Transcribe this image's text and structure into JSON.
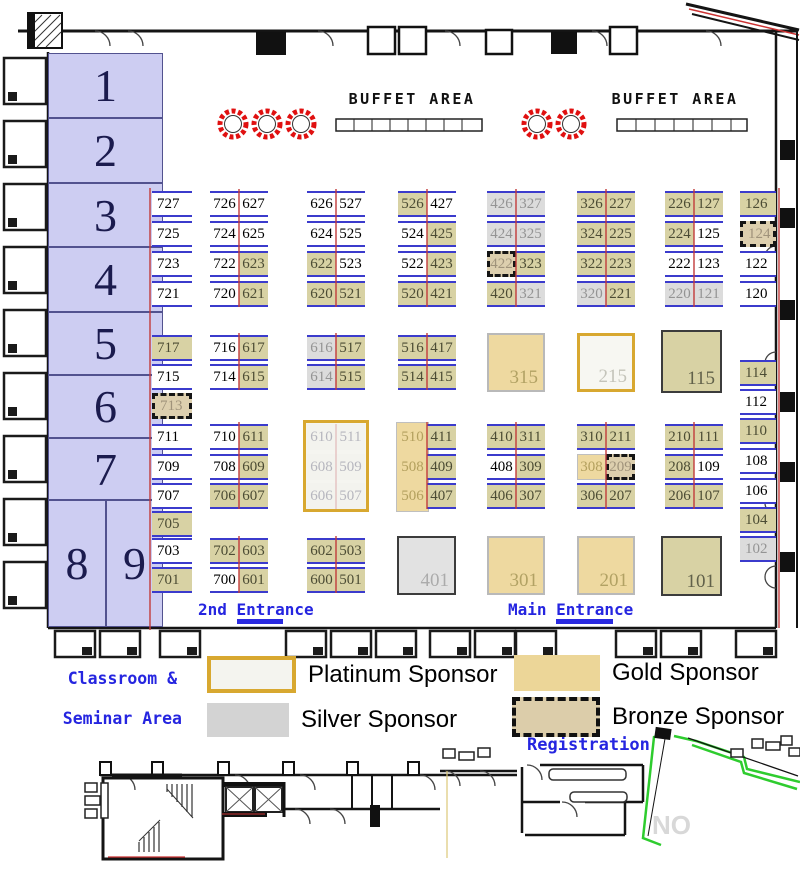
{
  "labels": {
    "buffet_area_1": "BUFFET AREA",
    "buffet_area_2": "BUFFET AREA",
    "second_entrance": "2nd Entrance",
    "main_entrance": "Main Entrance",
    "classroom_line1": "Classroom &",
    "classroom_line2": "Seminar Area",
    "registration": "Registration",
    "watermark": "NO"
  },
  "legend": {
    "items": [
      {
        "type": "platinum",
        "label": "Platinum Sponsor"
      },
      {
        "type": "silver",
        "label": "Silver Sponsor"
      },
      {
        "type": "gold",
        "label": "Gold Sponsor"
      },
      {
        "type": "bronze",
        "label": "Bronze Sponsor"
      }
    ]
  },
  "colors": {
    "gold_booth": "#d8d2a4",
    "gold_bright": "#eed9a0",
    "silver_booth": "#dcdcdc",
    "bronze_booth": "#ddcfae",
    "platinum_border": "#d8a830",
    "booth_line_blue": "#3b3bcc",
    "divider_red": "#cc2222",
    "label_blue": "#2525e0",
    "classroom_fill": "#cdcdf2"
  },
  "classrooms": {
    "fields": [
      "number",
      "x",
      "y",
      "w",
      "h"
    ],
    "rows": [
      [
        "1",
        48,
        53,
        115,
        65
      ],
      [
        "2",
        48,
        118,
        115,
        65
      ],
      [
        "3",
        48,
        183,
        115,
        64
      ],
      [
        "4",
        48,
        247,
        115,
        65
      ],
      [
        "5",
        48,
        312,
        115,
        63
      ],
      [
        "6",
        48,
        375,
        115,
        63
      ],
      [
        "7",
        48,
        438,
        115,
        62
      ],
      [
        "8",
        48,
        500,
        58,
        127
      ],
      [
        "9",
        106,
        500,
        57,
        127
      ]
    ]
  },
  "booths": {
    "fields": [
      "number",
      "x",
      "y",
      "w",
      "h",
      "type"
    ],
    "rows": [
      [
        "727",
        152,
        191,
        40,
        26,
        "std"
      ],
      [
        "725",
        152,
        221,
        40,
        26,
        "std"
      ],
      [
        "723",
        152,
        251,
        40,
        26,
        "std"
      ],
      [
        "721",
        152,
        281,
        40,
        26,
        "std"
      ],
      [
        "726",
        210,
        191,
        29,
        26,
        "std"
      ],
      [
        "627",
        239,
        191,
        29,
        26,
        "std"
      ],
      [
        "724",
        210,
        221,
        29,
        26,
        "std"
      ],
      [
        "625",
        239,
        221,
        29,
        26,
        "std"
      ],
      [
        "722",
        210,
        251,
        29,
        26,
        "std"
      ],
      [
        "623",
        239,
        251,
        29,
        26,
        "gold"
      ],
      [
        "720",
        210,
        281,
        29,
        26,
        "std"
      ],
      [
        "621",
        239,
        281,
        29,
        26,
        "gold"
      ],
      [
        "626",
        307,
        191,
        29,
        26,
        "std"
      ],
      [
        "527",
        336,
        191,
        29,
        26,
        "std"
      ],
      [
        "624",
        307,
        221,
        29,
        26,
        "std"
      ],
      [
        "525",
        336,
        221,
        29,
        26,
        "std"
      ],
      [
        "622",
        307,
        251,
        29,
        26,
        "gold"
      ],
      [
        "523",
        336,
        251,
        29,
        26,
        "std"
      ],
      [
        "620",
        307,
        281,
        29,
        26,
        "gold"
      ],
      [
        "521",
        336,
        281,
        29,
        26,
        "gold"
      ],
      [
        "526",
        398,
        191,
        29,
        26,
        "gold"
      ],
      [
        "427",
        427,
        191,
        29,
        26,
        "std"
      ],
      [
        "524",
        398,
        221,
        29,
        26,
        "std"
      ],
      [
        "425",
        427,
        221,
        29,
        26,
        "gold"
      ],
      [
        "522",
        398,
        251,
        29,
        26,
        "std"
      ],
      [
        "423",
        427,
        251,
        29,
        26,
        "gold"
      ],
      [
        "520",
        398,
        281,
        29,
        26,
        "gold"
      ],
      [
        "421",
        427,
        281,
        29,
        26,
        "gold"
      ],
      [
        "426",
        487,
        191,
        29,
        26,
        "silver"
      ],
      [
        "327",
        516,
        191,
        29,
        26,
        "silver"
      ],
      [
        "424",
        487,
        221,
        29,
        26,
        "silver"
      ],
      [
        "325",
        516,
        221,
        29,
        26,
        "silver"
      ],
      [
        "422",
        487,
        251,
        29,
        26,
        "bronze"
      ],
      [
        "323",
        516,
        251,
        29,
        26,
        "gold"
      ],
      [
        "420",
        487,
        281,
        29,
        26,
        "gold"
      ],
      [
        "321",
        516,
        281,
        29,
        26,
        "silver"
      ],
      [
        "326",
        577,
        191,
        29,
        26,
        "gold"
      ],
      [
        "227",
        606,
        191,
        29,
        26,
        "gold"
      ],
      [
        "324",
        577,
        221,
        29,
        26,
        "gold"
      ],
      [
        "225",
        606,
        221,
        29,
        26,
        "gold"
      ],
      [
        "322",
        577,
        251,
        29,
        26,
        "gold"
      ],
      [
        "223",
        606,
        251,
        29,
        26,
        "gold"
      ],
      [
        "320",
        577,
        281,
        29,
        26,
        "silver"
      ],
      [
        "221",
        606,
        281,
        29,
        26,
        "gold"
      ],
      [
        "226",
        665,
        191,
        29,
        26,
        "gold"
      ],
      [
        "127",
        694,
        191,
        29,
        26,
        "gold"
      ],
      [
        "224",
        665,
        221,
        29,
        26,
        "gold"
      ],
      [
        "125",
        694,
        221,
        29,
        26,
        "std"
      ],
      [
        "222",
        665,
        251,
        29,
        26,
        "std"
      ],
      [
        "123",
        694,
        251,
        29,
        26,
        "std"
      ],
      [
        "220",
        665,
        281,
        29,
        26,
        "silver"
      ],
      [
        "121",
        694,
        281,
        29,
        26,
        "silver"
      ],
      [
        "126",
        740,
        191,
        36,
        26,
        "gold"
      ],
      [
        "124",
        740,
        221,
        36,
        26,
        "bronze"
      ],
      [
        "122",
        740,
        251,
        36,
        26,
        "std"
      ],
      [
        "120",
        740,
        281,
        36,
        26,
        "std"
      ],
      [
        "717",
        152,
        335,
        40,
        26,
        "gold"
      ],
      [
        "715",
        152,
        364,
        40,
        26,
        "std"
      ],
      [
        "713",
        152,
        393,
        40,
        26,
        "bronze"
      ],
      [
        "716",
        210,
        335,
        29,
        26,
        "std"
      ],
      [
        "617",
        239,
        335,
        29,
        26,
        "gold"
      ],
      [
        "714",
        210,
        364,
        29,
        26,
        "std"
      ],
      [
        "615",
        239,
        364,
        29,
        26,
        "gold"
      ],
      [
        "616",
        307,
        335,
        29,
        26,
        "silver"
      ],
      [
        "517",
        336,
        335,
        29,
        26,
        "gold"
      ],
      [
        "614",
        307,
        364,
        29,
        26,
        "silver"
      ],
      [
        "515",
        336,
        364,
        29,
        26,
        "gold"
      ],
      [
        "516",
        398,
        335,
        29,
        26,
        "gold"
      ],
      [
        "417",
        427,
        335,
        29,
        26,
        "gold"
      ],
      [
        "514",
        398,
        364,
        29,
        26,
        "gold"
      ],
      [
        "415",
        427,
        364,
        29,
        26,
        "gold"
      ],
      [
        "315",
        487,
        333,
        58,
        59,
        "goldb"
      ],
      [
        "215",
        577,
        333,
        58,
        59,
        "plat"
      ],
      [
        "115",
        661,
        330,
        61,
        63,
        "bigg"
      ],
      [
        "114",
        740,
        360,
        36,
        26,
        "gold"
      ],
      [
        "112",
        740,
        389,
        36,
        26,
        "std"
      ],
      [
        "711",
        152,
        424,
        40,
        26,
        "std"
      ],
      [
        "709",
        152,
        454,
        40,
        26,
        "std"
      ],
      [
        "707",
        152,
        483,
        40,
        26,
        "std"
      ],
      [
        "705",
        152,
        511,
        40,
        26,
        "gold"
      ],
      [
        "710",
        210,
        424,
        29,
        26,
        "std"
      ],
      [
        "611",
        239,
        424,
        29,
        26,
        "gold"
      ],
      [
        "708",
        210,
        454,
        29,
        26,
        "std"
      ],
      [
        "609",
        239,
        454,
        29,
        26,
        "gold"
      ],
      [
        "706",
        210,
        483,
        29,
        26,
        "gold"
      ],
      [
        "607",
        239,
        483,
        29,
        26,
        "gold"
      ],
      [
        "610",
        307,
        424,
        29,
        26,
        "platc"
      ],
      [
        "511",
        336,
        424,
        29,
        26,
        "platc"
      ],
      [
        "608",
        307,
        454,
        29,
        26,
        "platc"
      ],
      [
        "509",
        336,
        454,
        29,
        26,
        "platc"
      ],
      [
        "606",
        307,
        483,
        29,
        26,
        "platc"
      ],
      [
        "507",
        336,
        483,
        29,
        26,
        "platc"
      ],
      [
        "510",
        398,
        424,
        29,
        26,
        "goldf"
      ],
      [
        "411",
        427,
        424,
        29,
        26,
        "gold"
      ],
      [
        "508",
        398,
        454,
        29,
        26,
        "goldf"
      ],
      [
        "409",
        427,
        454,
        29,
        26,
        "gold"
      ],
      [
        "506",
        398,
        483,
        29,
        26,
        "goldf"
      ],
      [
        "407",
        427,
        483,
        29,
        26,
        "gold"
      ],
      [
        "410",
        487,
        424,
        29,
        26,
        "gold"
      ],
      [
        "311",
        516,
        424,
        29,
        26,
        "gold"
      ],
      [
        "408",
        487,
        454,
        29,
        26,
        "std"
      ],
      [
        "309",
        516,
        454,
        29,
        26,
        "gold"
      ],
      [
        "406",
        487,
        483,
        29,
        26,
        "gold"
      ],
      [
        "307",
        516,
        483,
        29,
        26,
        "gold"
      ],
      [
        "310",
        577,
        424,
        29,
        26,
        "gold"
      ],
      [
        "211",
        606,
        424,
        29,
        26,
        "gold"
      ],
      [
        "308",
        577,
        454,
        29,
        26,
        "goldc"
      ],
      [
        "209",
        606,
        454,
        29,
        26,
        "bronze"
      ],
      [
        "306",
        577,
        483,
        29,
        26,
        "gold"
      ],
      [
        "207",
        606,
        483,
        29,
        26,
        "gold"
      ],
      [
        "210",
        665,
        424,
        29,
        26,
        "gold"
      ],
      [
        "111",
        694,
        424,
        29,
        26,
        "gold"
      ],
      [
        "208",
        665,
        454,
        29,
        26,
        "gold"
      ],
      [
        "109",
        694,
        454,
        29,
        26,
        "std"
      ],
      [
        "206",
        665,
        483,
        29,
        26,
        "gold"
      ],
      [
        "107",
        694,
        483,
        29,
        26,
        "gold"
      ],
      [
        "110",
        740,
        418,
        36,
        26,
        "gold"
      ],
      [
        "108",
        740,
        448,
        36,
        26,
        "std"
      ],
      [
        "106",
        740,
        478,
        36,
        26,
        "std"
      ],
      [
        "104",
        740,
        507,
        36,
        26,
        "gold"
      ],
      [
        "102",
        740,
        536,
        36,
        26,
        "silver"
      ],
      [
        "703",
        152,
        538,
        40,
        26,
        "std"
      ],
      [
        "701",
        152,
        567,
        40,
        26,
        "gold"
      ],
      [
        "702",
        210,
        538,
        29,
        26,
        "gold"
      ],
      [
        "603",
        239,
        538,
        29,
        26,
        "gold"
      ],
      [
        "700",
        210,
        567,
        29,
        26,
        "std"
      ],
      [
        "601",
        239,
        567,
        29,
        26,
        "gold"
      ],
      [
        "602",
        307,
        538,
        29,
        26,
        "gold"
      ],
      [
        "503",
        336,
        538,
        29,
        26,
        "gold"
      ],
      [
        "600",
        307,
        567,
        29,
        26,
        "gold"
      ],
      [
        "501",
        336,
        567,
        29,
        26,
        "gold"
      ],
      [
        "401",
        397,
        536,
        59,
        59,
        "bigs"
      ],
      [
        "301",
        487,
        536,
        58,
        59,
        "goldb"
      ],
      [
        "201",
        577,
        536,
        58,
        59,
        "goldb"
      ],
      [
        "101",
        661,
        536,
        61,
        60,
        "bigg"
      ]
    ]
  }
}
